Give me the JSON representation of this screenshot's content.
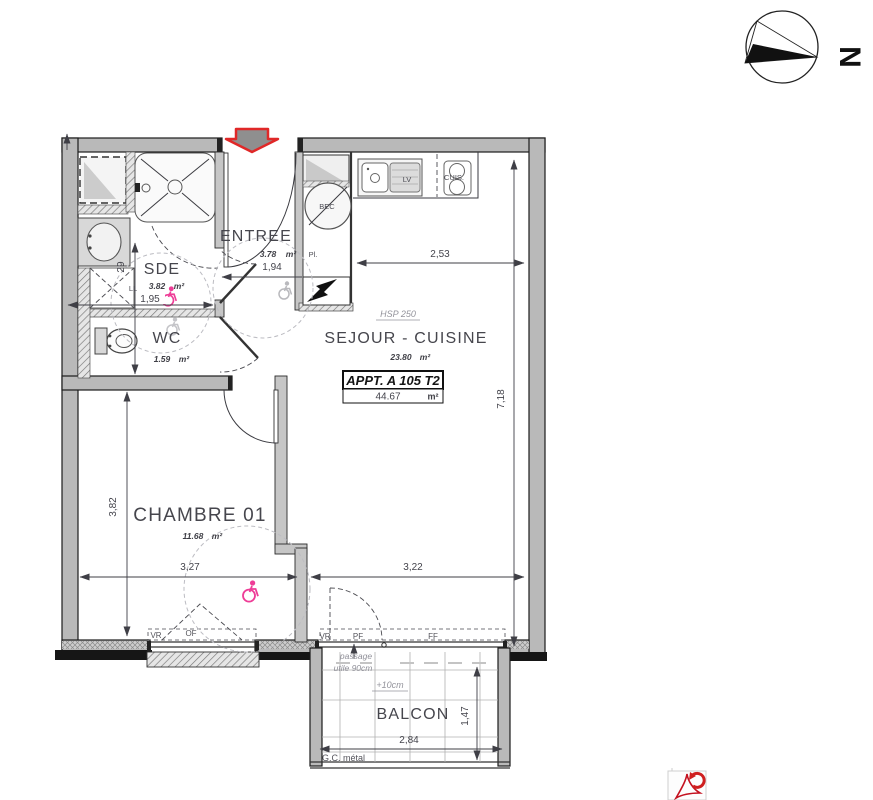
{
  "compass": {
    "north_label": "N"
  },
  "apartment": {
    "name": "APPT. A 105 T2",
    "area": "44.67",
    "area_unit": "m²",
    "hsp": "HSP 250"
  },
  "rooms": {
    "entree": {
      "name": "ENTREE",
      "area": "3.78",
      "unit": "m²"
    },
    "sde": {
      "name": "SDE",
      "area": "3.82",
      "unit": "m²"
    },
    "wc": {
      "name": "WC",
      "area": "1.59",
      "unit": "m²"
    },
    "chambre": {
      "name": "CHAMBRE 01",
      "area": "11.68",
      "unit": "m²"
    },
    "sejour": {
      "name": "SEJOUR - CUISINE",
      "area": "23.80",
      "unit": "m²"
    },
    "balcon": {
      "name": "BALCON"
    }
  },
  "dimensions": {
    "kitchen_width": "2,53",
    "entree_width": "1,94",
    "sde_width": "1,95",
    "sde_side": "29",
    "sejour_height": "7,18",
    "chambre_height": "3,82",
    "chambre_width": "3,27",
    "sejour_width": "3,22",
    "balcon_width": "2,84",
    "balcon_depth": "1,47"
  },
  "fixtures": {
    "water_heater": "BEC",
    "closet": "Pl.",
    "dishwasher": "LV",
    "cooker": "CUIS.",
    "washer": "LL"
  },
  "openings": {
    "chambre_shutter": "VR",
    "chambre_window": "OF",
    "balcon_shutter": "VR",
    "balcon_door": "PF",
    "balcon_fixed": "FF"
  },
  "notes": {
    "passage_line1": "passage",
    "passage_line2": "utile 90cm",
    "level": "+10cm",
    "structure": "G.C. métal"
  },
  "colors": {
    "wall_gray": "#b9b9b9",
    "entrance_arrow_red": "#e02828",
    "accessibility_pink": "#ee3d97",
    "dimension_text": "#44444c",
    "pdf_red": "#c41220"
  }
}
